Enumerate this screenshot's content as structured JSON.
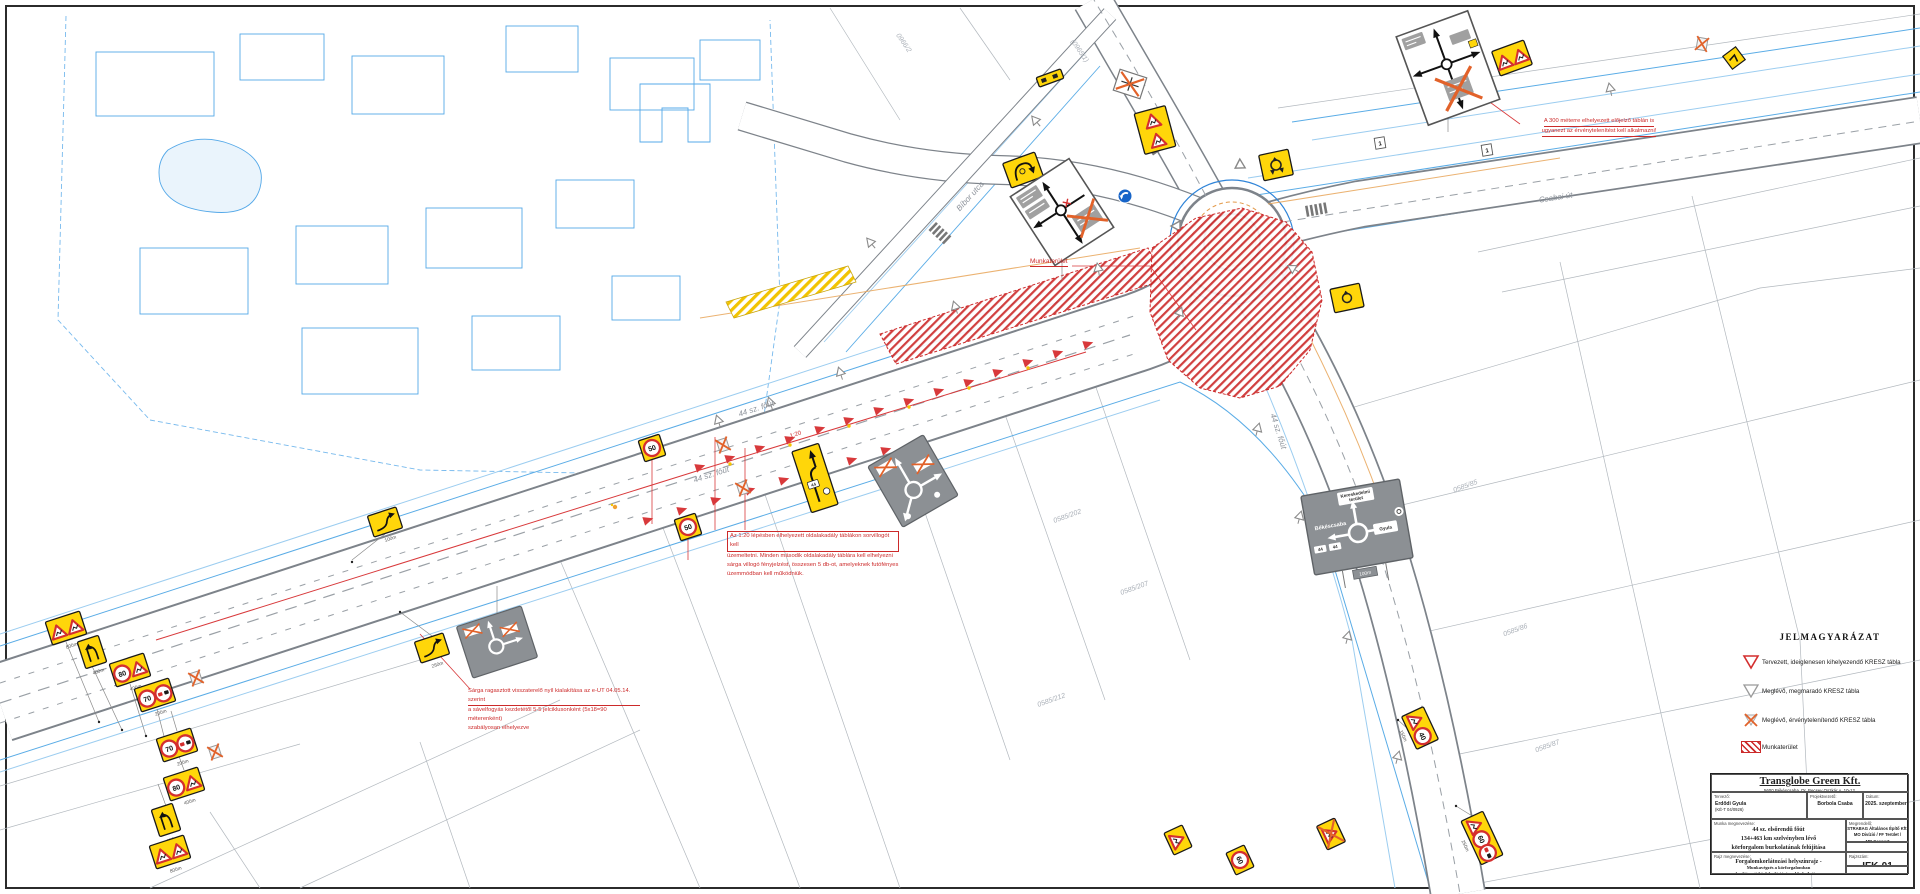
{
  "drawing": {
    "road_labels": {
      "road44_a": "44 sz. főút",
      "road44_b": "44 sz. főút",
      "road44_c": "44 sz. főút",
      "csabai": "Csabai út",
      "bibor": "Bíbor utca"
    },
    "parcels": {
      "p1": "0585/85",
      "p2": "0585/86",
      "p3": "0585/87",
      "p4": "0585/202",
      "p5": "0585/207",
      "p6": "0585/212",
      "p7": "(0965/1)",
      "p8": "0966/2"
    },
    "distances": {
      "d800": "800m",
      "d400": "400m",
      "d200": "200m",
      "d100": "100m",
      "d250": "250m",
      "d150": "150m"
    },
    "sign_texts": {
      "s40": "40",
      "s50": "50",
      "s60": "60",
      "s70": "70",
      "s80": "80",
      "route44": "44",
      "gyula": "Gyula",
      "bekescsaba": "Békéscsaba",
      "keresk1": "Kereskedelmi",
      "keresk2": "terület",
      "marker": "1"
    },
    "taper_label": "1:20",
    "work_area_label": "Munkaterület",
    "notes": {
      "invalidate_line1": "A 300 méterre elhelyezett előjelző táblán is",
      "invalidate_line2": "ugyanezt az érvénytelenítést kell alkalmazni!",
      "flasher_line1": "Az 1:20 lépésben elhelyezett oldalakadály táblákon sorvillogót kell",
      "flasher_line2": "üzemeltetni. Minden második oldalakadály táblára kell elhelyezni",
      "flasher_line3": "sárga villogó fényjelzést, összesen 5 db-ot, amelyeknek futófényes",
      "flasher_line4": "üzemmódban kell működniük.",
      "arrow_line1": "Sárga ragasztott visszaterelő nyíl kialakítása az e-UT 04.05.14. szerint",
      "arrow_line2": "a sávelfogyás kezdetétől 5-5 jelciklusonként (5x18=90 méterenként)",
      "arrow_line3": "szabályosan elhelyezve"
    }
  },
  "legend": {
    "title": "JELMAGYARÁZAT",
    "items": [
      {
        "label": "Tervezett, ideiglenesen kihelyezendő KRESZ tábla"
      },
      {
        "label": "Meglévő, megmaradó KRESZ tábla"
      },
      {
        "label": "Meglévő, érvénytelenítendő KRESZ tábla"
      },
      {
        "label": "Munkaterület"
      }
    ]
  },
  "title_block": {
    "company": "Transglobe Green Kft.",
    "address": "5600 Békéscsaba, Dr. Becsey Oszkár u. 10-12.",
    "designer_label": "Tervező:",
    "designer_name": "Erdődi Gyula",
    "designer_reg": "(KÉ-T 04/0926)",
    "pm_label": "Projektvezető:",
    "pm_name": "Borbola Csaba",
    "date_label": "Dátum:",
    "date_value": "2025. szeptember",
    "work_label": "Munka megnevezése:",
    "work_line1": "44 sz. elsőrendű főút",
    "work_line2": "134+463 km szelvényben lévő",
    "work_line3": "körforgalom burkolatának felújítása",
    "client_label": "Megrendelő:",
    "client_line1": "STRABAG Általános Építő Kft.",
    "client_line2": "MO Divízió / FF Terület /",
    "client_line3": "MB Csoport",
    "client_line4": "5600 Békéscsaba, Ipari út 4.",
    "worknum_label": "Munkaszám:",
    "worknum_value": "TG-0905-25",
    "drawing_label": "Rajz megnevezése:",
    "drawing_line1": "Forgalomkorlátozási helyszínrajz -",
    "drawing_line2": "Munkavégzés a körforgalomban",
    "drawing_line3": "korlátozott közlekedési irányokkal - I. ütem",
    "number_label": "Rajzszám:",
    "number_value": "IFK-01",
    "scale_label": "Méretarány:",
    "scale_value": "1:500"
  }
}
